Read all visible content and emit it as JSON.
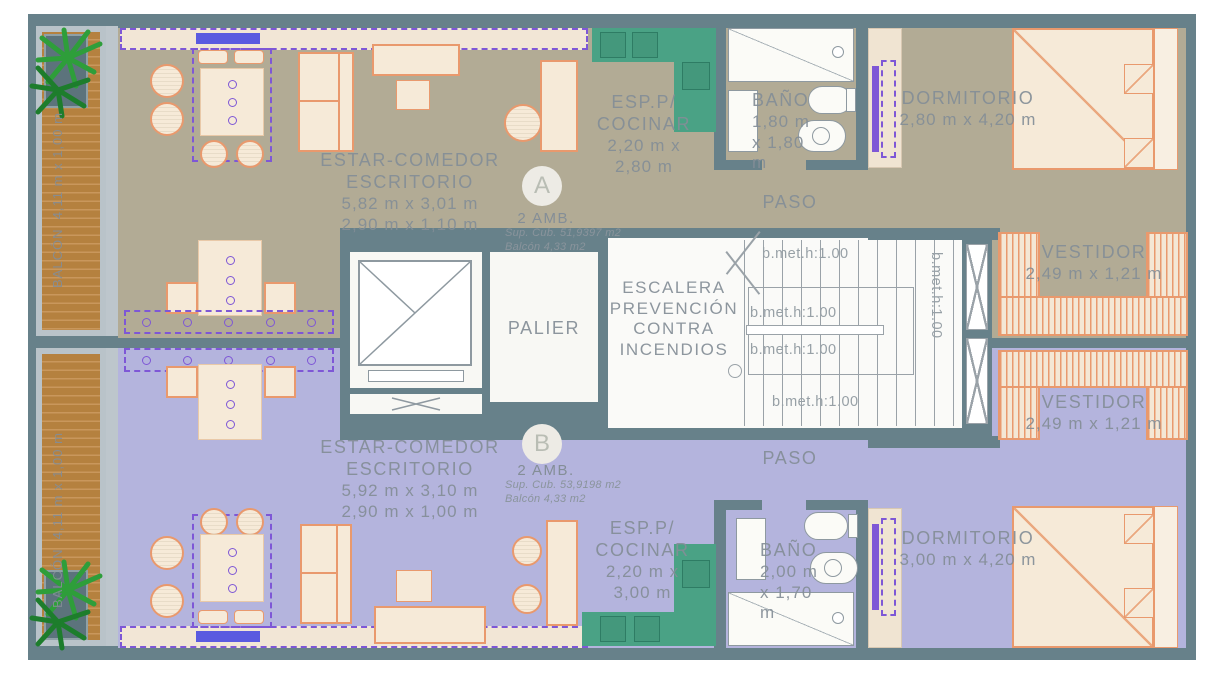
{
  "units": {
    "a": {
      "badge": "A",
      "type": "2 AMB.",
      "sup": "Sup. Cub. 51,9397 m2",
      "balc": "Balcón 4,33 m2",
      "living1": "ESTAR-COMEDOR",
      "living2": "ESCRITORIO",
      "living_dim1": "5,82 m x 3,01 m",
      "living_dim2": "2,90 m x 1,10 m",
      "kitchen1": "ESP.P/",
      "kitchen2": "COCINAR",
      "kitchen_dim1": "2,20 m x",
      "kitchen_dim2": "2,80 m",
      "bath": "BAÑO",
      "bath_dim1": "1,80 m",
      "bath_dim2": "x 1,80 m",
      "paso": "PASO",
      "bedroom": "DORMITORIO",
      "bedroom_dim": "2,80 m x 4,20 m",
      "vestidor": "VESTIDOR",
      "vestidor_dim": "2,49 m x 1,21 m",
      "balcony": "BALCÓN",
      "balcony_dim": "4,11 m x 1,00 m"
    },
    "b": {
      "badge": "B",
      "type": "2 AMB.",
      "sup": "Sup. Cub. 53,9198 m2",
      "balc": "Balcón 4,33 m2",
      "living1": "ESTAR-COMEDOR",
      "living2": "ESCRITORIO",
      "living_dim1": "5,92 m x 3,10 m",
      "living_dim2": "2,90 m x 1,00 m",
      "kitchen1": "ESP.P/",
      "kitchen2": "COCINAR",
      "kitchen_dim1": "2,20 m x",
      "kitchen_dim2": "3,00 m",
      "bath": "BAÑO",
      "bath_dim1": "2,00 m",
      "bath_dim2": "x 1,70 m",
      "paso": "PASO",
      "bedroom": "DORMITORIO",
      "bedroom_dim": "3,00 m x 4,20 m",
      "vestidor": "VESTIDOR",
      "vestidor_dim": "2,49 m x 1,21 m",
      "balcony": "BALCÓN",
      "balcony_dim": "4,11 m x 1,00 m"
    }
  },
  "core": {
    "palier": "PALIER",
    "stairs1": "ESCALERA",
    "stairs2": "PREVENCIÓN",
    "stairs3": "CONTRA",
    "stairs4": "INCENDIOS",
    "rail": "b.met.h:1.00"
  },
  "colors": {
    "wall": "#67818a",
    "floor_unit_a": "#b2ab95",
    "floor_unit_b": "#b4b4dd",
    "kitchen_counter": "#4aa285",
    "furniture_fill": "#f6ead8",
    "furniture_outline": "#e9996d",
    "deck_wood": "#b5813f",
    "accent_purple": "#7e57d6",
    "accent_blue": "#5a5ae0",
    "label_gray": "#848e97",
    "plant_green": "#2e9e3a"
  }
}
